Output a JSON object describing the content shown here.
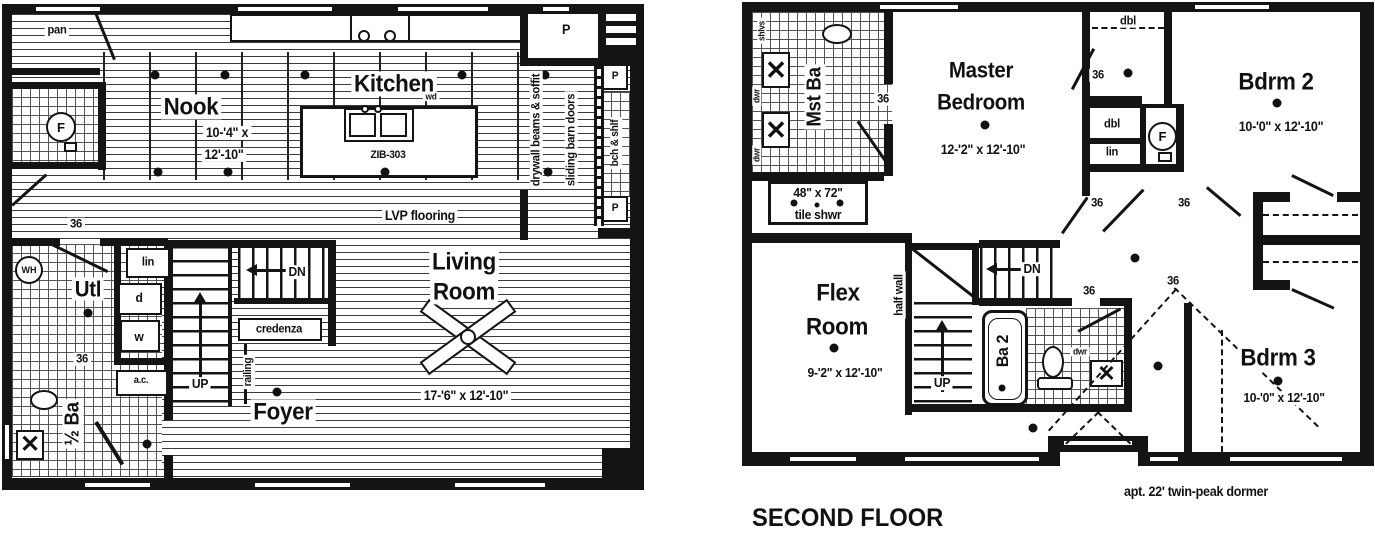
{
  "first_floor": {
    "rooms": {
      "nook": {
        "name": "Nook",
        "dims1": "10-'4\" x",
        "dims2": "12'-10\""
      },
      "kitchen": {
        "name": "Kitchen"
      },
      "living": {
        "line1": "Living",
        "line2": "Room",
        "dims": "17-'6\" x 12'-10\""
      },
      "foyer": {
        "name": "Foyer"
      },
      "utility": {
        "name": "Utl"
      },
      "half_bath": {
        "name": "½ Ba"
      }
    },
    "labels": {
      "pantry": "pan",
      "pantry_room": "P",
      "post_upper": "P",
      "post_lower": "P",
      "island_model": "ZIB-303",
      "dishwasher": "wd",
      "flooring": "LVP flooring",
      "beams_note": "drywall beams & soffit",
      "barn_doors_note": "sliding barn doors",
      "bench_note": "bch & shlf",
      "linen": "lin",
      "dryer": "d",
      "washer": "w",
      "air_cond": "a.c.",
      "stairs_up": "UP",
      "stairs_down": "DN",
      "credenza": "credenza",
      "railing": "railing",
      "furnace": "F",
      "water_heater": "WH",
      "door_utl": "36",
      "door_half_bath": "36"
    }
  },
  "second_floor": {
    "title": "SECOND FLOOR",
    "dormer_note": "apt. 22' twin-peak dormer",
    "rooms": {
      "master": {
        "line1": "Master",
        "line2": "Bedroom",
        "dims": "12-'2\" x 12'-10\""
      },
      "bdrm2": {
        "name": "Bdrm 2",
        "dims": "10-'0\" x 12'-10\""
      },
      "bdrm3": {
        "name": "Bdrm 3",
        "dims": "10-'0\" x 12'-10\""
      },
      "flex": {
        "line1": "Flex",
        "line2": "Room",
        "dims": "9-'2\" x 12'-10\""
      },
      "master_bath": {
        "name": "Mst Ba"
      },
      "bath2": {
        "name": "Ba 2"
      }
    },
    "labels": {
      "shelves": "shlvs",
      "drawers_upper": "dwr",
      "drawers_lower": "dwr",
      "shower_size": "48\" x 72\"",
      "shower_type": "tile shwr",
      "closet_dbl_wic": "dbl",
      "closet_dbl_hall": "dbl",
      "closet_linen": "lin",
      "furnace": "F",
      "half_wall": "half wall",
      "stairs_up": "UP",
      "stairs_down": "DN",
      "vanity_drawers": "dwr",
      "door_master_bath": "36",
      "door_wic": "36",
      "door_hall_a": "36",
      "door_hall_b": "36",
      "door_bath2": "36",
      "door_bdrm3": "36"
    }
  }
}
